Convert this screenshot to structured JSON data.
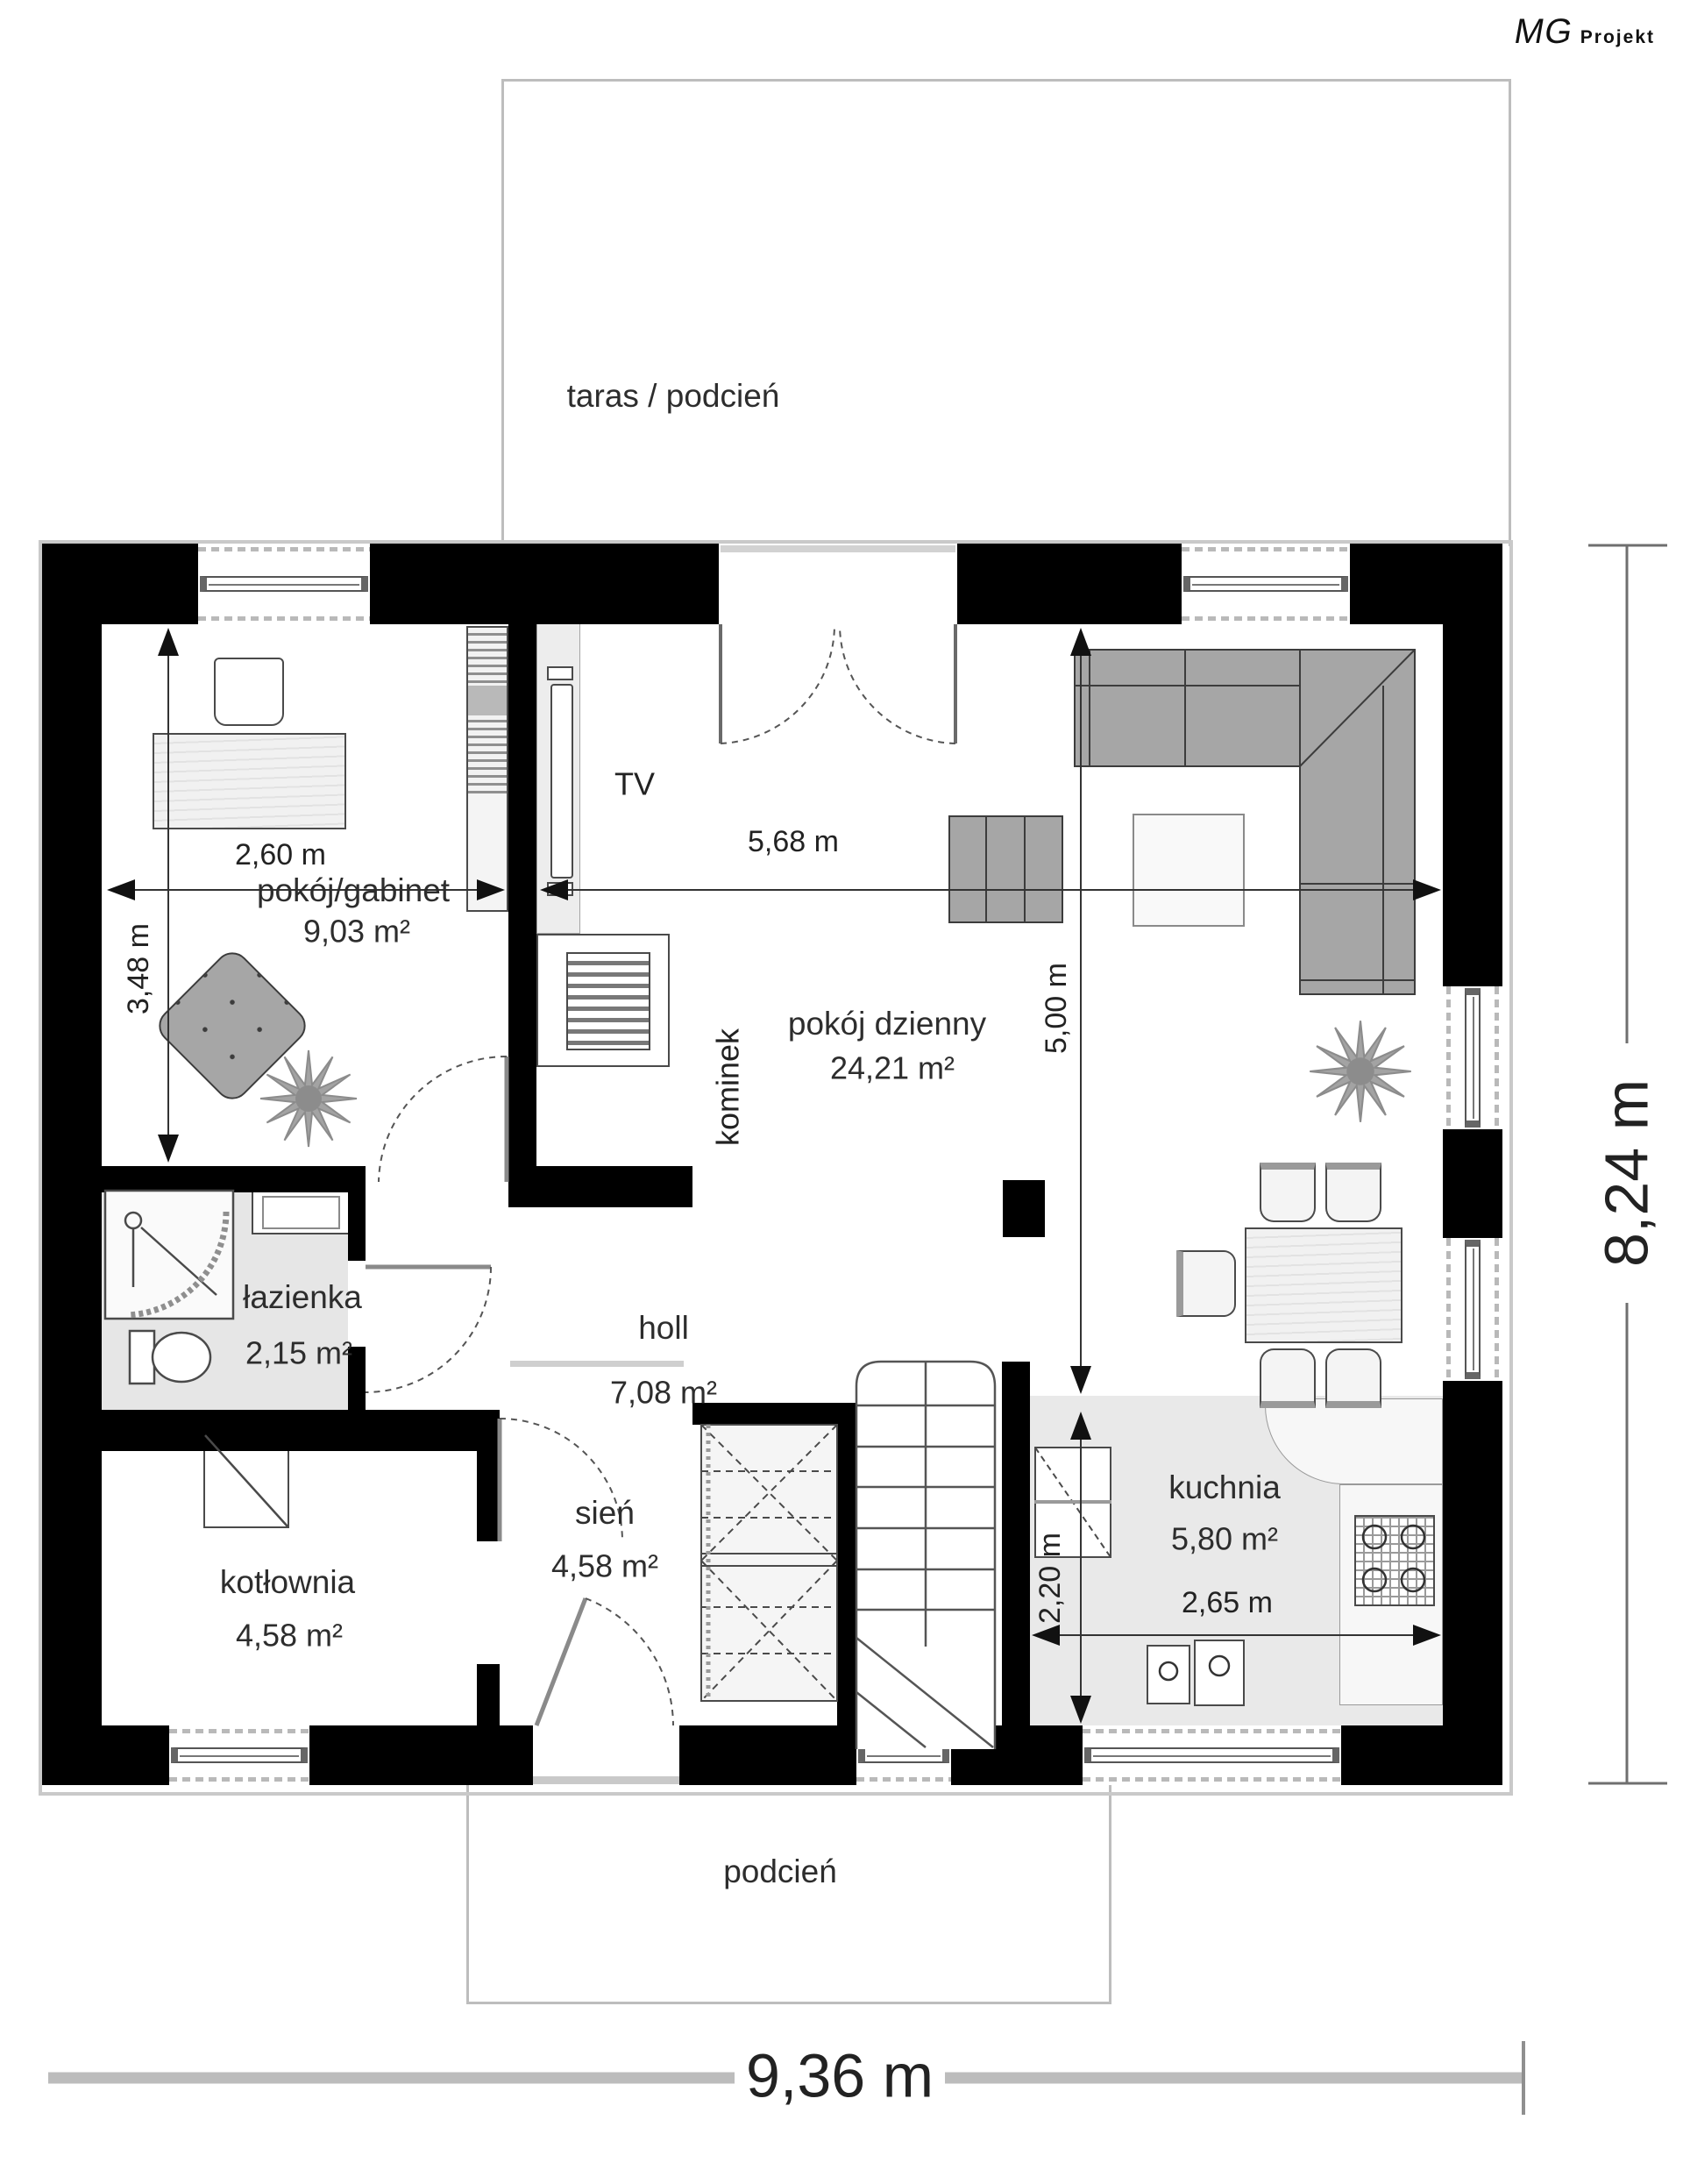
{
  "logo": {
    "mg": "MG",
    "projekt": "Projekt"
  },
  "rooms": {
    "taras": {
      "name": "taras / podcień"
    },
    "gabinet": {
      "name": "pokój/gabinet",
      "area": "9,03 m²"
    },
    "dzienny": {
      "name": "pokój dzienny",
      "area": "24,21 m²"
    },
    "lazienka": {
      "name": "łazienka",
      "area": "2,15 m²"
    },
    "holl": {
      "name": "holl",
      "area": "7,08 m²"
    },
    "kotlownia": {
      "name": "kotłownia",
      "area": "4,58 m²"
    },
    "sien": {
      "name": "sień",
      "area": "4,58 m²"
    },
    "kuchnia": {
      "name": "kuchnia",
      "area": "5,80 m²"
    },
    "podcien": {
      "name": "podcień"
    }
  },
  "fixtures": {
    "tv": "TV",
    "kominek": "kominek"
  },
  "dimensions": {
    "gabinet_width": "2,60 m",
    "gabinet_depth": "3,48 m",
    "dzienny_width": "5,68 m",
    "dzienny_depth": "5,00 m",
    "kuchnia_depth": "2,20 m",
    "kuchnia_width": "2,65 m",
    "house_depth": "8,24 m",
    "house_width": "9,36 m"
  },
  "colors": {
    "wall": "#000000",
    "floor_gray": "#e6e6e6",
    "sofa_gray": "#a6a6a6",
    "outline_gray": "#bdbdbd"
  }
}
